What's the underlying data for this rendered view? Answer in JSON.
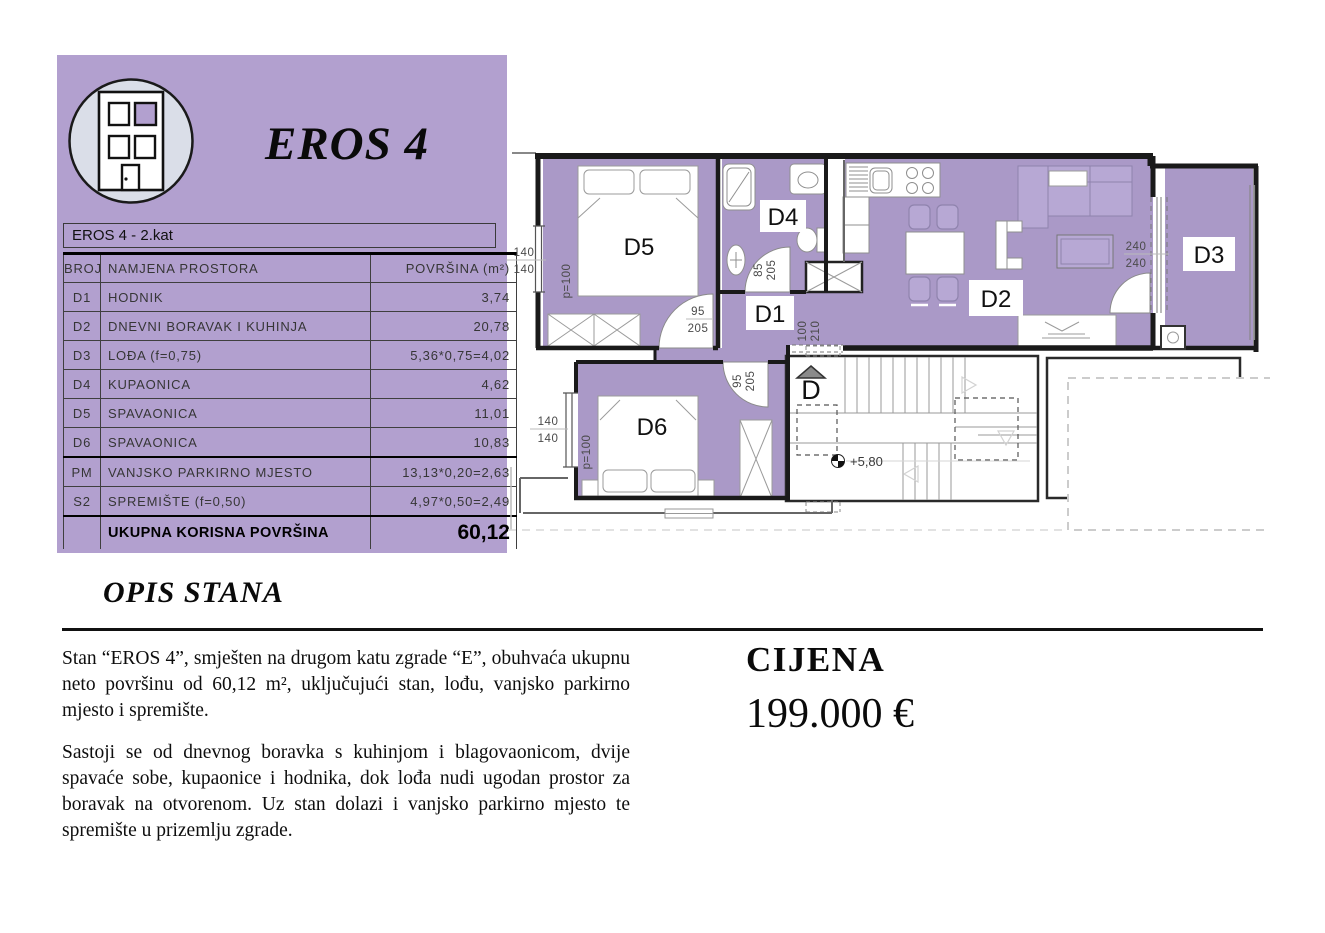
{
  "card": {
    "title": "EROS 4",
    "subtitle": "EROS 4 - 2.kat"
  },
  "table": {
    "columns": [
      "BROJ",
      "NAMJENA PROSTORA",
      "POVRŠINA (m²)"
    ],
    "rows": [
      {
        "id": "D1",
        "name": "HODNIK",
        "area": "3,74"
      },
      {
        "id": "D2",
        "name": "DNEVNI BORAVAK I KUHINJA",
        "area": "20,78"
      },
      {
        "id": "D3",
        "name": "LOĐA (f=0,75)",
        "area": "5,36*0,75=4,02"
      },
      {
        "id": "D4",
        "name": "KUPAONICA",
        "area": "4,62"
      },
      {
        "id": "D5",
        "name": "SPAVAONICA",
        "area": "11,01"
      },
      {
        "id": "D6",
        "name": "SPAVAONICA",
        "area": "10,83"
      },
      {
        "id": "PM",
        "name": "VANJSKO PARKIRNO MJESTO",
        "area": "13,13*0,20=2,63"
      },
      {
        "id": "S2",
        "name": "SPREMIŠTE (f=0,50)",
        "area": "4,97*0,50=2,49"
      }
    ],
    "total_label": "UKUPNA KORISNA POVRŠINA",
    "total_value": "60,12"
  },
  "floorplan": {
    "rooms": {
      "d1": "D1",
      "d2": "D2",
      "d3": "D3",
      "d4": "D4",
      "d5": "D5",
      "d6": "D6",
      "stairs": "D"
    },
    "dims": {
      "window_d5_top": "140",
      "window_d5_bottom": "140",
      "p_d5": "p=100",
      "window_d6_top": "140",
      "window_d6_bottom": "140",
      "p_d6": "p=100",
      "door_d5_w": "95",
      "door_d5_h": "205",
      "door_d4_w": "85",
      "door_d4_h": "205",
      "door_d6_w": "95",
      "door_d6_h": "205",
      "door_stairs_w": "100",
      "door_stairs_h": "210",
      "slider_w": "240",
      "slider_h": "240",
      "level": "+5,80"
    }
  },
  "description": {
    "heading": "OPIS STANA",
    "paragraph1": "Stan “EROS 4”, smješten na drugom katu zgrade “E”, obuhvaća ukupnu neto površinu od 60,12 m², uključujući stan, lođu, vanjsko parkirno mjesto i spremište.",
    "paragraph2": "Sastoji se od dnevnog boravka s kuhinjom i blagovaonicom, dvije spavaće sobe, kupaonice i hodnika, dok lođa nudi ugodan prostor za boravak na otvorenom. Uz stan dolazi i vanjsko parkirno mjesto te spremište u prizemlju zgrade."
  },
  "price": {
    "label": "CIJENA",
    "value": "199.000 €"
  },
  "colors": {
    "card_bg": "#b2a0cf",
    "floor_fill": "#aa99c7",
    "furniture_tint": "#b7a8d4"
  }
}
